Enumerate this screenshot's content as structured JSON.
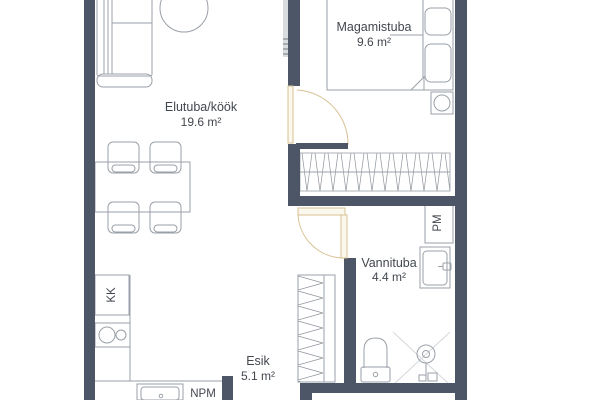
{
  "floorplan": {
    "rooms": [
      {
        "name": "Elutuba/köök",
        "area": "19.6 m²"
      },
      {
        "name": "Magamistuba",
        "area": "9.6 m²"
      },
      {
        "name": "Vannituba",
        "area": "4.4 m²"
      },
      {
        "name": "Esik",
        "area": "5.1 m²"
      }
    ],
    "appliance_labels": {
      "fridge": "KK",
      "washing_machine": "PM",
      "dishwasher": "NPM"
    }
  },
  "colors": {
    "wall": "#4d5666",
    "door": "#d8c193",
    "text": "#42474e",
    "furniture": "#9aa0a8",
    "hatch": "#8d939b"
  }
}
